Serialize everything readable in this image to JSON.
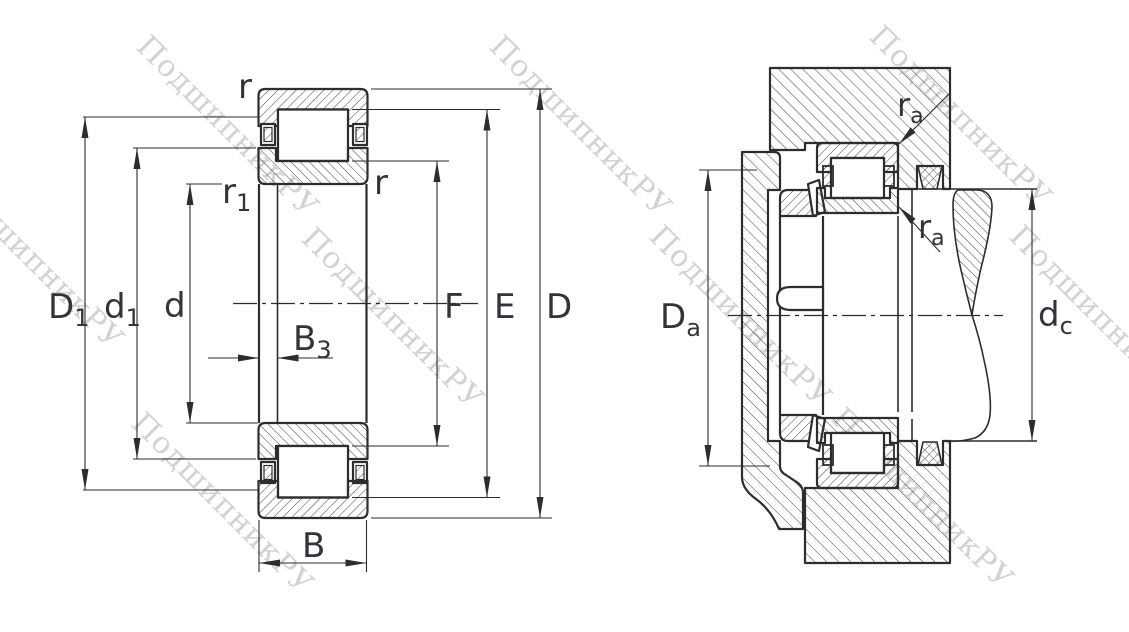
{
  "watermark": {
    "text": "ПодшипникРУ",
    "color": "#c8c8c8"
  },
  "drawing": {
    "background": "#ffffff",
    "line_color": "#2d2d2d",
    "label_color": "#30343b"
  },
  "left_view": {
    "labels": {
      "D1": {
        "base": "D",
        "sub": "1"
      },
      "d1": {
        "base": "d",
        "sub": "1"
      },
      "d": {
        "base": "d",
        "sub": ""
      },
      "B3": {
        "base": "B",
        "sub": "3"
      },
      "B": {
        "base": "B",
        "sub": ""
      },
      "F": {
        "base": "F",
        "sub": ""
      },
      "E": {
        "base": "E",
        "sub": ""
      },
      "D": {
        "base": "D",
        "sub": ""
      },
      "r_top": {
        "base": "r",
        "sub": ""
      },
      "r_inner": {
        "base": "r",
        "sub": ""
      },
      "r1": {
        "base": "r",
        "sub": "1"
      }
    }
  },
  "right_view": {
    "labels": {
      "Da": {
        "base": "D",
        "sub": "a"
      },
      "dc": {
        "base": "d",
        "sub": "c"
      },
      "ra_top": {
        "base": "r",
        "sub": "a"
      },
      "ra_bottom": {
        "base": "r",
        "sub": "a"
      }
    }
  }
}
